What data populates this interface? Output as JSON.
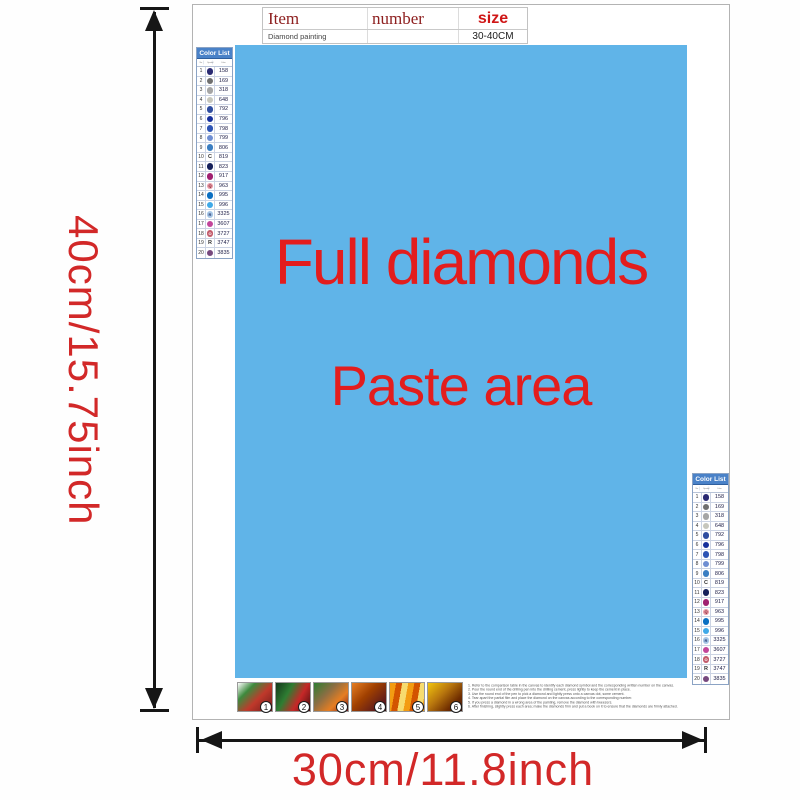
{
  "dimensions": {
    "height_label": "40cm/15.75inch",
    "width_label": "30cm/11.8inch",
    "label_color": "#d22828",
    "arrow_color": "#161616"
  },
  "spec_table": {
    "col_item": "Item",
    "col_number": "number",
    "col_size": "size",
    "row_item": "Diamond painting",
    "row_number": "",
    "row_size": "30-40CM"
  },
  "canvas": {
    "line1": "Full diamonds",
    "line2": "Paste area",
    "bg_color": "#60b4e8",
    "text_color": "#e31d1d"
  },
  "color_list": {
    "title": "Color List",
    "col_no": "No.",
    "col_symbol": "Symbol",
    "col_color": "Color",
    "header_bg": "#4a82c8",
    "rows": [
      {
        "no": "1",
        "letter": "",
        "bg": "#2a2a72",
        "fg": "#ffffff",
        "code": "158"
      },
      {
        "no": "2",
        "letter": "",
        "bg": "#6f6f6f",
        "fg": "#ffffff",
        "code": "169"
      },
      {
        "no": "3",
        "letter": "",
        "bg": "#a5a5a5",
        "fg": "#ffffff",
        "code": "318"
      },
      {
        "no": "4",
        "letter": "",
        "bg": "#c6c6bc",
        "fg": "#555555",
        "code": "648"
      },
      {
        "no": "5",
        "letter": "",
        "bg": "#2f4da0",
        "fg": "#ffffff",
        "code": "792"
      },
      {
        "no": "6",
        "letter": "",
        "bg": "#17309c",
        "fg": "#ffffff",
        "code": "796"
      },
      {
        "no": "7",
        "letter": "",
        "bg": "#2d54b4",
        "fg": "#ffffff",
        "code": "798"
      },
      {
        "no": "8",
        "letter": "",
        "bg": "#6e8ed2",
        "fg": "#ffffff",
        "code": "799"
      },
      {
        "no": "9",
        "letter": "",
        "bg": "#3a7ec2",
        "fg": "#ffffff",
        "code": "806"
      },
      {
        "no": "10",
        "letter": "C",
        "bg": "",
        "fg": "#333333",
        "code": "819"
      },
      {
        "no": "11",
        "letter": "",
        "bg": "#15205a",
        "fg": "#ffffff",
        "code": "823"
      },
      {
        "no": "12",
        "letter": "",
        "bg": "#a02070",
        "fg": "#ffffff",
        "code": "917"
      },
      {
        "no": "13",
        "letter": "Q",
        "bg": "#e89aa6",
        "fg": "#7a2030",
        "code": "963"
      },
      {
        "no": "14",
        "letter": "",
        "bg": "#0a6fc2",
        "fg": "#ffffff",
        "code": "995"
      },
      {
        "no": "15",
        "letter": "",
        "bg": "#3fa9e8",
        "fg": "#ffffff",
        "code": "996"
      },
      {
        "no": "16",
        "letter": "R",
        "bg": "#a6c6e6",
        "fg": "#24356e",
        "code": "3325"
      },
      {
        "no": "17",
        "letter": "",
        "bg": "#c2459a",
        "fg": "#ffffff",
        "code": "3607"
      },
      {
        "no": "18",
        "letter": "O",
        "bg": "#c25a6a",
        "fg": "#ffffff",
        "code": "3727"
      },
      {
        "no": "19",
        "letter": "R",
        "bg": "",
        "fg": "#333333",
        "code": "3747"
      },
      {
        "no": "20",
        "letter": "",
        "bg": "#77497e",
        "fg": "#ffffff",
        "code": "3835"
      }
    ]
  },
  "steps": [
    "1",
    "2",
    "3",
    "4",
    "5",
    "6"
  ],
  "instructions": [
    "1. Refer to the comparison table in the canvas to identify each diamond symbol and the corresponding written number on the canvas.",
    "2. Pour the round end of the drilling pen into the drilling cement, press lightly to keep the cement in place.",
    "3. Use the round end of the pen to pick a diamond and lightly press onto a canvas dot, some cement.",
    "4. Tear apart the partial film and place the diamond on the canvas according to the corresponding number.",
    "5. If you press a diamond in a wrong area of the painting, remove the diamond with tweezers.",
    "6. After finishing, slightly press each area; make the diamonds firm and put a book on it to ensure that the diamonds are firmly attached."
  ]
}
